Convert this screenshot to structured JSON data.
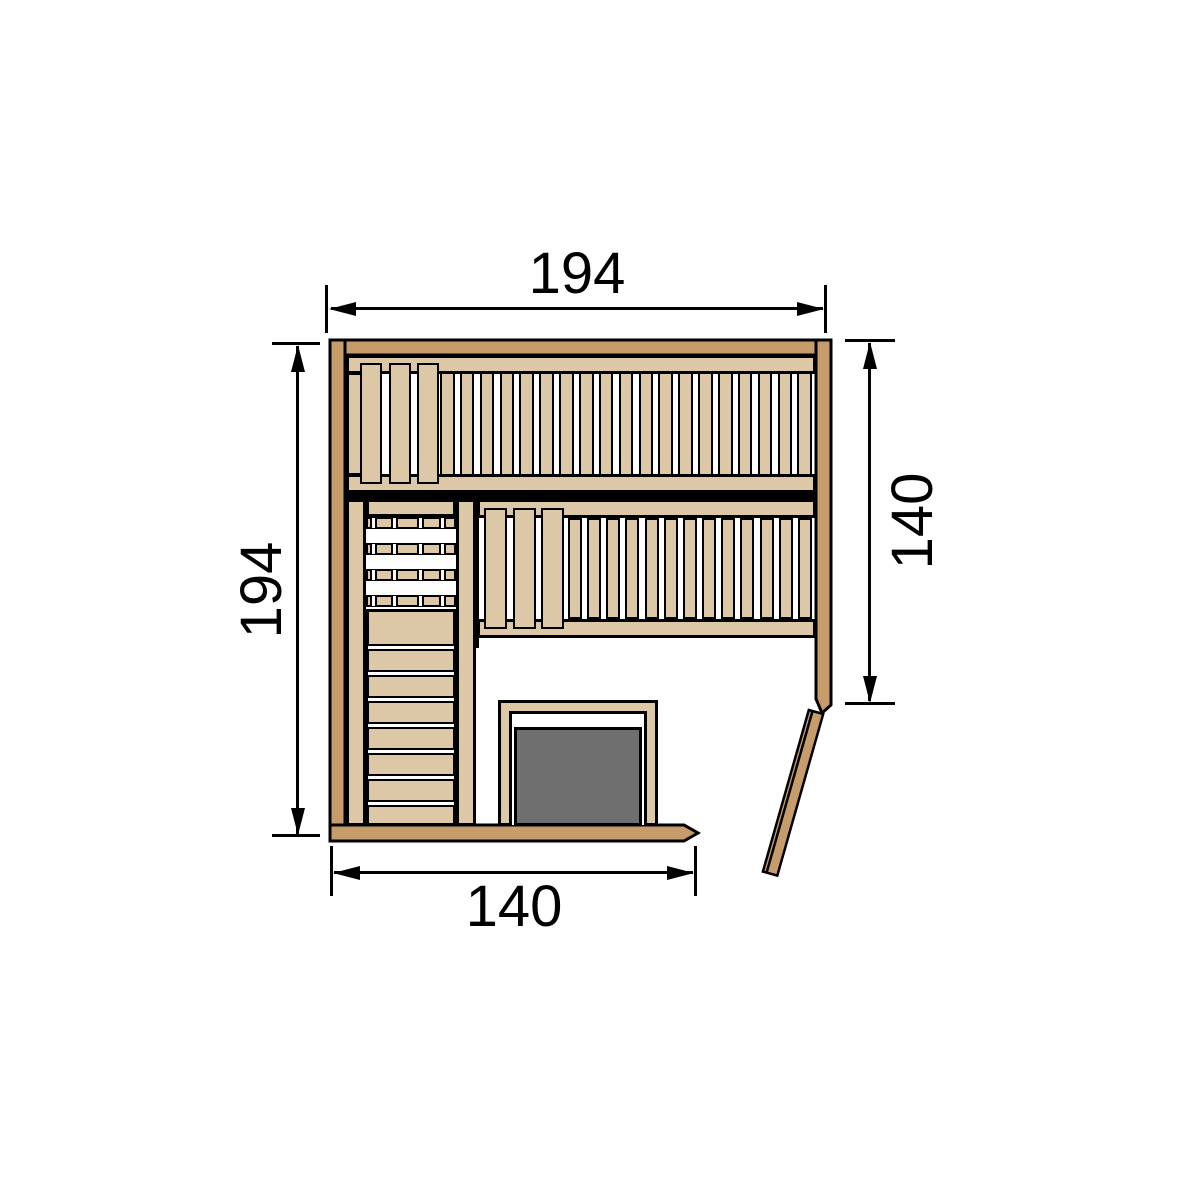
{
  "dimensions": {
    "top_width": "194",
    "left_height": "194",
    "right_height": "140",
    "bottom_width": "140"
  },
  "colors": {
    "wall_wood": "#c69c6a",
    "bench_wood": "#dcc7a6",
    "heater_gray": "#6f6f6f",
    "outline": "#000000",
    "background": "#ffffff"
  },
  "diagram": {
    "kind": "sauna-floor-plan-top-view",
    "top_bench": {
      "wide_slats": 3,
      "narrow_slats": 19
    },
    "right_bench": {
      "wide_slats": 3,
      "narrow_slats": 13
    },
    "left_bench": {
      "dashed_slats": 4,
      "gaps_per_dashed_slat": 4,
      "plain_slats": 8
    },
    "heater": {
      "present": true,
      "position": "bottom-center"
    },
    "door": {
      "state": "open",
      "position": "bottom-right"
    }
  }
}
